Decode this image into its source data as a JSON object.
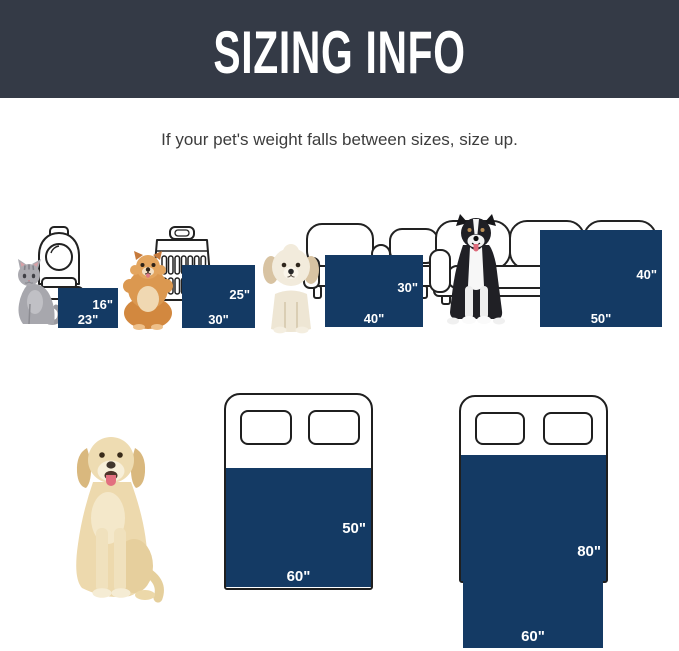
{
  "header": {
    "title": "SIZING INFO",
    "background": "#343a46",
    "text_color": "#ffffff"
  },
  "subtitle": {
    "text": "If your pet's weight falls between sizes, size up.",
    "color": "#3d3d3d"
  },
  "colors": {
    "header_bg": "#343a46",
    "blanket_navy": "#143a64",
    "furniture_outline": "#222222",
    "label_text": "#ffffff"
  },
  "sizes": {
    "row1": [
      {
        "pet_icon": "cat",
        "furniture_icon": "backpack-carrier",
        "height_label": "16\"",
        "width_label": "23\"",
        "width_in": 23,
        "height_in": 16
      },
      {
        "pet_icon": "pomeranian",
        "furniture_icon": "travel-crate",
        "height_label": "25\"",
        "width_label": "30\"",
        "width_in": 30,
        "height_in": 25
      },
      {
        "pet_icon": "white-puppy",
        "furniture_icon": "armchair",
        "height_label": "30\"",
        "width_label": "40\"",
        "width_in": 40,
        "height_in": 30
      },
      {
        "pet_icon": "border-collie",
        "furniture_icon": "sofa",
        "height_label": "40\"",
        "width_label": "50\"",
        "width_in": 50,
        "height_in": 40
      }
    ],
    "row2": [
      {
        "pet_icon": "golden-retriever",
        "furniture_icon": "bed",
        "height_label": "50\"",
        "width_label": "60\"",
        "width_in": 60,
        "height_in": 50
      },
      {
        "furniture_icon": "bed-with-overhang",
        "height_label": "80\"",
        "width_label": "60\"",
        "width_in": 60,
        "height_in": 80
      }
    ]
  }
}
